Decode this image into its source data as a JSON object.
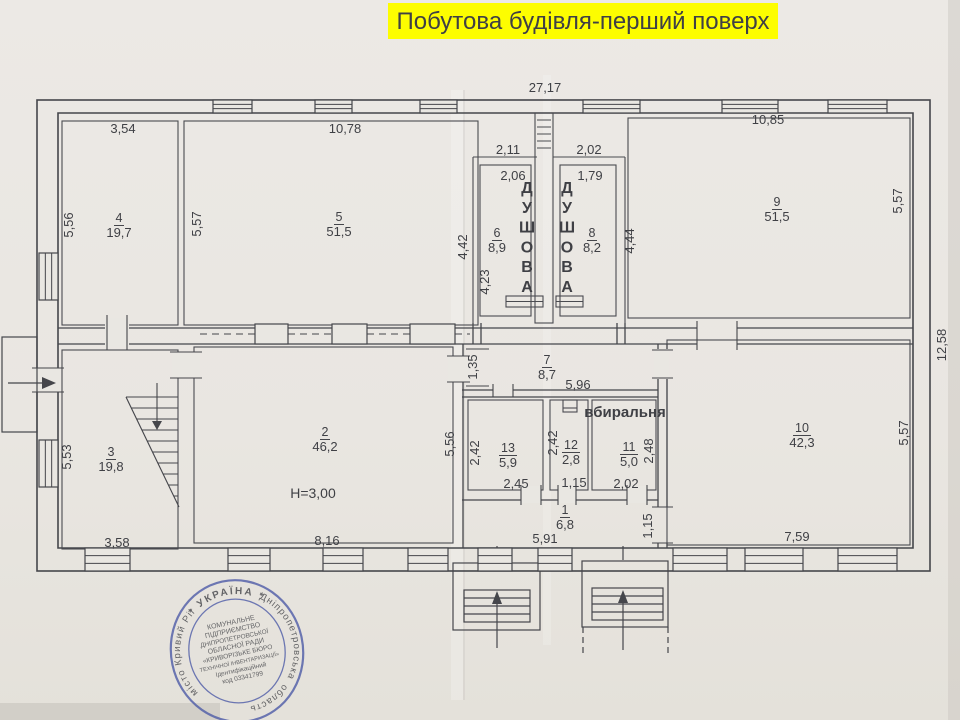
{
  "title": {
    "text": "Побутова будівля-перший поверх"
  },
  "colors": {
    "paper": "#e9e7e2",
    "ink": "#45464b",
    "title_bg": "#fdfd00",
    "title_text": "#000000",
    "stamp_blue": "#4a58a6"
  },
  "plan": {
    "overall_width_label": "27,17",
    "overall_right_label": "12,58",
    "height_note": "H=3,00",
    "rooms": [
      {
        "number": "1",
        "area": "6,8",
        "x": 565,
        "y": 514
      },
      {
        "number": "2",
        "area": "46,2",
        "x": 325,
        "y": 436
      },
      {
        "number": "3",
        "area": "19,8",
        "x": 111,
        "y": 456
      },
      {
        "number": "4",
        "area": "19,7",
        "x": 119,
        "y": 222
      },
      {
        "number": "5",
        "area": "51,5",
        "x": 339,
        "y": 221
      },
      {
        "number": "6",
        "area": "8,9",
        "x": 497,
        "y": 237
      },
      {
        "number": "7",
        "area": "8,7",
        "x": 547,
        "y": 364
      },
      {
        "number": "8",
        "area": "8,2",
        "x": 592,
        "y": 237
      },
      {
        "number": "9",
        "area": "51,5",
        "x": 777,
        "y": 206
      },
      {
        "number": "10",
        "area": "42,3",
        "x": 802,
        "y": 432
      },
      {
        "number": "11",
        "area": "5,0",
        "x": 629,
        "y": 451
      },
      {
        "number": "12",
        "area": "2,8",
        "x": 571,
        "y": 449
      },
      {
        "number": "13",
        "area": "5,9",
        "x": 508,
        "y": 452
      }
    ],
    "dims": [
      {
        "t": "27,17",
        "x": 545,
        "y": 92,
        "r": 0
      },
      {
        "t": "3,54",
        "x": 123,
        "y": 133,
        "r": 0
      },
      {
        "t": "10,78",
        "x": 345,
        "y": 133,
        "r": 0
      },
      {
        "t": "10,85",
        "x": 768,
        "y": 124,
        "r": 0
      },
      {
        "t": "2,11",
        "x": 508,
        "y": 154,
        "r": 0
      },
      {
        "t": "2,02",
        "x": 589,
        "y": 154,
        "r": 0
      },
      {
        "t": "2,06",
        "x": 513,
        "y": 180,
        "r": 0
      },
      {
        "t": "1,79",
        "x": 590,
        "y": 180,
        "r": 0
      },
      {
        "t": "5,56",
        "x": 73,
        "y": 225,
        "r": -90
      },
      {
        "t": "5,57",
        "x": 201,
        "y": 224,
        "r": -90
      },
      {
        "t": "4,42",
        "x": 467,
        "y": 247,
        "r": -90
      },
      {
        "t": "4,23",
        "x": 489,
        "y": 282,
        "r": -90
      },
      {
        "t": "4,44",
        "x": 634,
        "y": 241,
        "r": -90
      },
      {
        "t": "5,57",
        "x": 902,
        "y": 201,
        "r": -90
      },
      {
        "t": "12,58",
        "x": 946,
        "y": 345,
        "r": -90
      },
      {
        "t": "1,35",
        "x": 477,
        "y": 367,
        "r": -90
      },
      {
        "t": "5,96",
        "x": 578,
        "y": 389,
        "r": 0
      },
      {
        "t": "5,56",
        "x": 454,
        "y": 444,
        "r": -90
      },
      {
        "t": "5,53",
        "x": 71,
        "y": 457,
        "r": -90
      },
      {
        "t": "2,42",
        "x": 479,
        "y": 453,
        "r": -90
      },
      {
        "t": "2,42",
        "x": 557,
        "y": 443,
        "r": -90
      },
      {
        "t": "2,48",
        "x": 653,
        "y": 451,
        "r": -90
      },
      {
        "t": "5,57",
        "x": 908,
        "y": 433,
        "r": -90
      },
      {
        "t": "2,45",
        "x": 516,
        "y": 488,
        "r": 0
      },
      {
        "t": "1,15",
        "x": 574,
        "y": 487,
        "r": 0
      },
      {
        "t": "2,02",
        "x": 626,
        "y": 488,
        "r": 0
      },
      {
        "t": "3,58",
        "x": 117,
        "y": 547,
        "r": 0
      },
      {
        "t": "8,16",
        "x": 327,
        "y": 545,
        "r": 0
      },
      {
        "t": "5,91",
        "x": 545,
        "y": 543,
        "r": 0
      },
      {
        "t": "1,15",
        "x": 652,
        "y": 526,
        "r": -90
      },
      {
        "t": "7,59",
        "x": 797,
        "y": 541,
        "r": 0
      }
    ],
    "annotations": [
      {
        "text": "ДУШОВА",
        "x": 527,
        "y": 193,
        "vertical": true,
        "size": 16
      },
      {
        "text": "ДУШОВА",
        "x": 567,
        "y": 193,
        "vertical": true,
        "size": 16
      },
      {
        "text": "вбиральня",
        "x": 625,
        "y": 417,
        "vertical": false,
        "size": 15,
        "bold": true
      },
      {
        "text": "H=3,00",
        "x": 313,
        "y": 498,
        "vertical": false,
        "size": 14,
        "bold": false
      }
    ]
  },
  "stamp": {
    "arc_left": "місто Кривий Ріг",
    "arc_top": "*  УКРАЇНА  *",
    "arc_right": "Дніпропетровська",
    "arc_bottom": "область",
    "center_lines": [
      "КОМУНАЛЬНЕ",
      "ПІДПРИЄМСТВО",
      "ДНІПРОПЕТРОВСЬКОЇ",
      "ОБЛАСНОЇ РАДИ",
      "«КРИВОРІЗЬКЕ БЮРО",
      "ТЕХНІЧНОЇ ІНВЕНТАРИЗАЦІЇ»",
      "Ідентифікаційний",
      "код 03341799"
    ]
  }
}
